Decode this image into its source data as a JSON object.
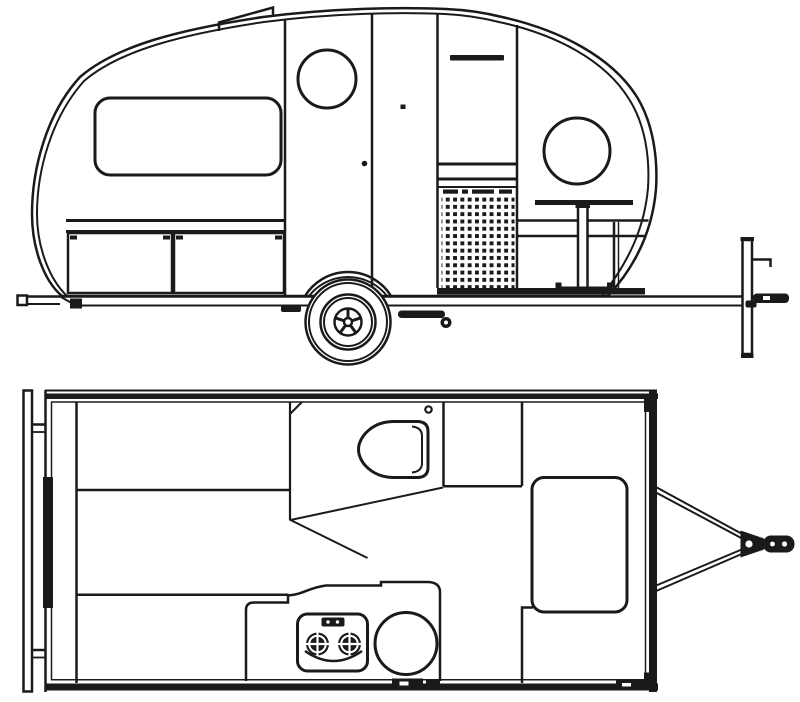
{
  "page": {
    "background": "#ffffff",
    "line_color": "#1a1a1a",
    "content_type": "teardrop camper trailer technical line drawing, two views"
  },
  "side_view": {
    "name": "side-elevation-view",
    "parts": [
      "body-profile",
      "roof-vent",
      "side-window",
      "entry-door",
      "door-handle",
      "porthole-window-front",
      "porthole-window-rear",
      "galley-cabinet",
      "cabinet-handle",
      "vent-slots",
      "perforated-panel",
      "dinette-table",
      "table-pedestal",
      "bench-seat",
      "storage-compartments",
      "fender",
      "wheel",
      "leaf-spring",
      "chassis-rail",
      "rear-bumper-bar",
      "tongue-jack",
      "hitch-coupler"
    ]
  },
  "plan_view": {
    "name": "floor-plan-view",
    "parts": [
      "rear-bumper",
      "body-shell-walls",
      "hatch-hinge-bar",
      "corner-brackets",
      "interior-partition",
      "bed-platform-lines",
      "entry-opening",
      "divider-diagonals",
      "roof-vent",
      "ceiling-light-dot",
      "galley-counter",
      "two-burner-stove",
      "stove-knob-panel",
      "sink",
      "storage-box",
      "footwell-compartment",
      "entry-steps",
      "a-frame-tongue",
      "hitch-coupler"
    ]
  }
}
